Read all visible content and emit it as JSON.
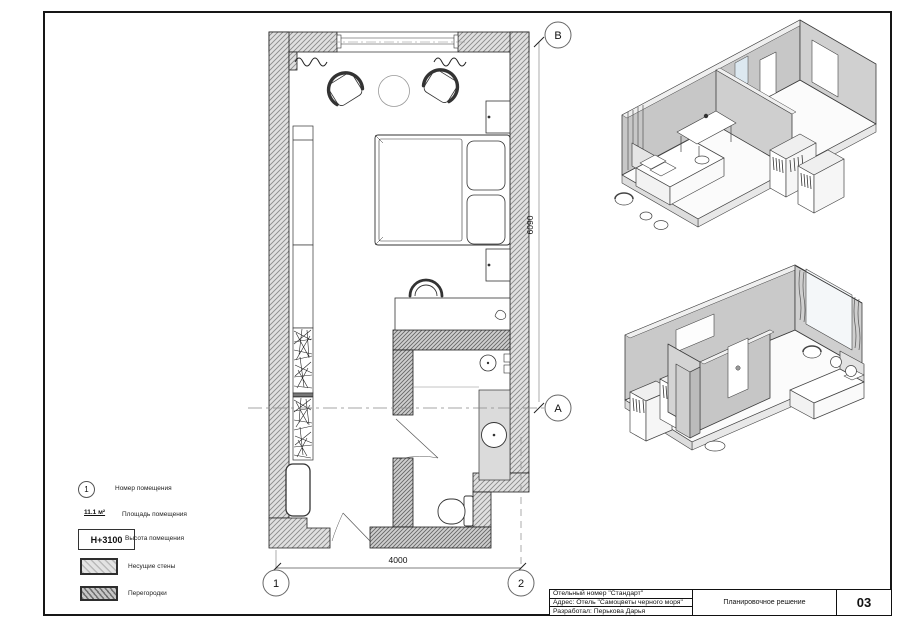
{
  "title_block": {
    "project": "Отельный номер \"Стандарт\"",
    "address": "Адрес:  Отель \"Самоцветы черного моря\"",
    "author": "Разработал: Перькова Дарья",
    "drawing_title": "Планировочное решение",
    "sheet_number": "03"
  },
  "legend": {
    "room_number": {
      "symbol": "1",
      "label": "Номер помещения"
    },
    "area": {
      "symbol": "11.1 м²",
      "label": "Площадь помещения"
    },
    "height": {
      "symbol": "Н+3100",
      "label": "Высота помещения"
    },
    "load_bearing": {
      "label": "Несущие стены"
    },
    "partitions": {
      "label": "Перегородки"
    }
  },
  "plan": {
    "dim_width": "4000",
    "dim_height": "6090",
    "axis_1": "1",
    "axis_2": "2",
    "axis_a": "A",
    "axis_b": "B"
  },
  "colors": {
    "wall_hatch_gray": "#d9d9d9",
    "partition_gray": "#cfcfcf",
    "glass_blue": "#dce8f0"
  }
}
